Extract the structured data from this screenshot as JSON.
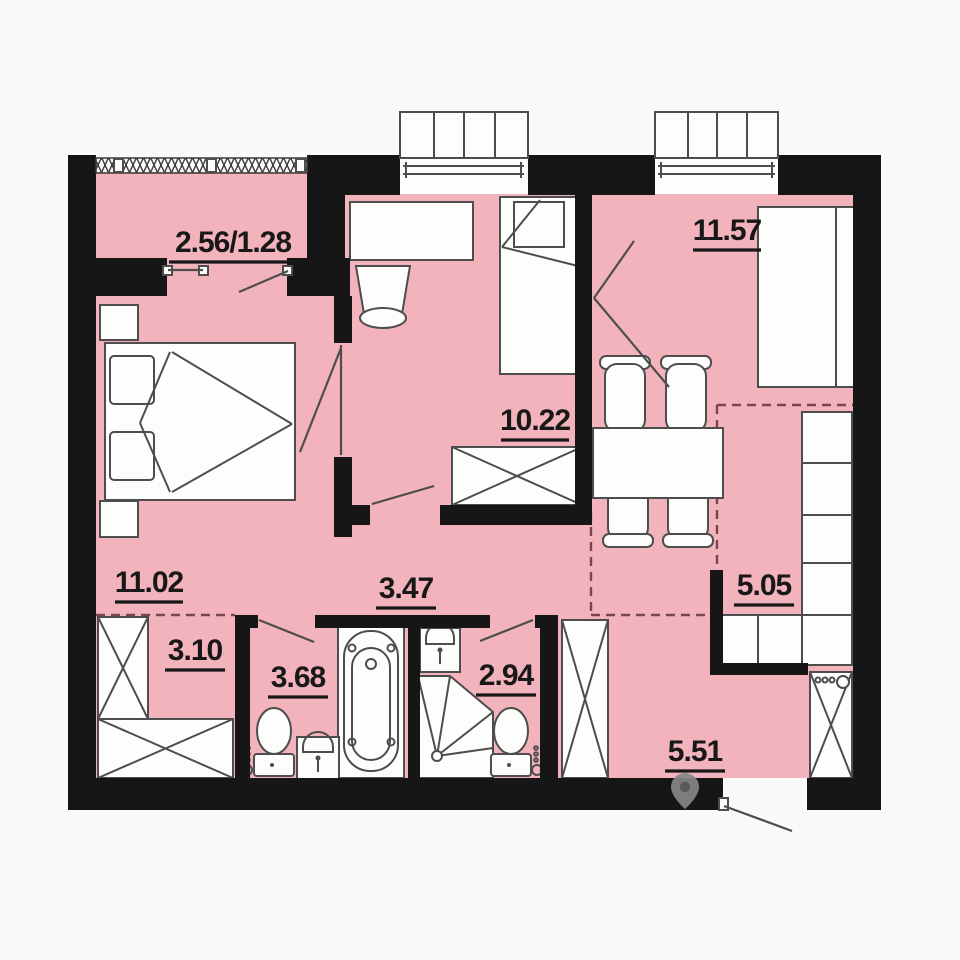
{
  "rooms": {
    "balcony": {
      "area": "2.56/1.28"
    },
    "living_room": {
      "area": "11.57"
    },
    "kids_room": {
      "area": "10.22"
    },
    "bedroom": {
      "area": "11.02"
    },
    "corridor": {
      "area": "3.47"
    },
    "wardrobe": {
      "area": "3.10"
    },
    "bathroom": {
      "area": "3.68"
    },
    "shower_room": {
      "area": "2.94"
    },
    "kitchen": {
      "area": "5.05"
    },
    "hall": {
      "area": "5.51"
    }
  },
  "icons": {
    "watermark": "location-pin"
  },
  "colors": {
    "floor": "#f3b3bc",
    "wall": "#161616",
    "furniture_line": "#4d4d4d",
    "zone_dash": "#7a464e",
    "background": "#fbfaf8"
  }
}
